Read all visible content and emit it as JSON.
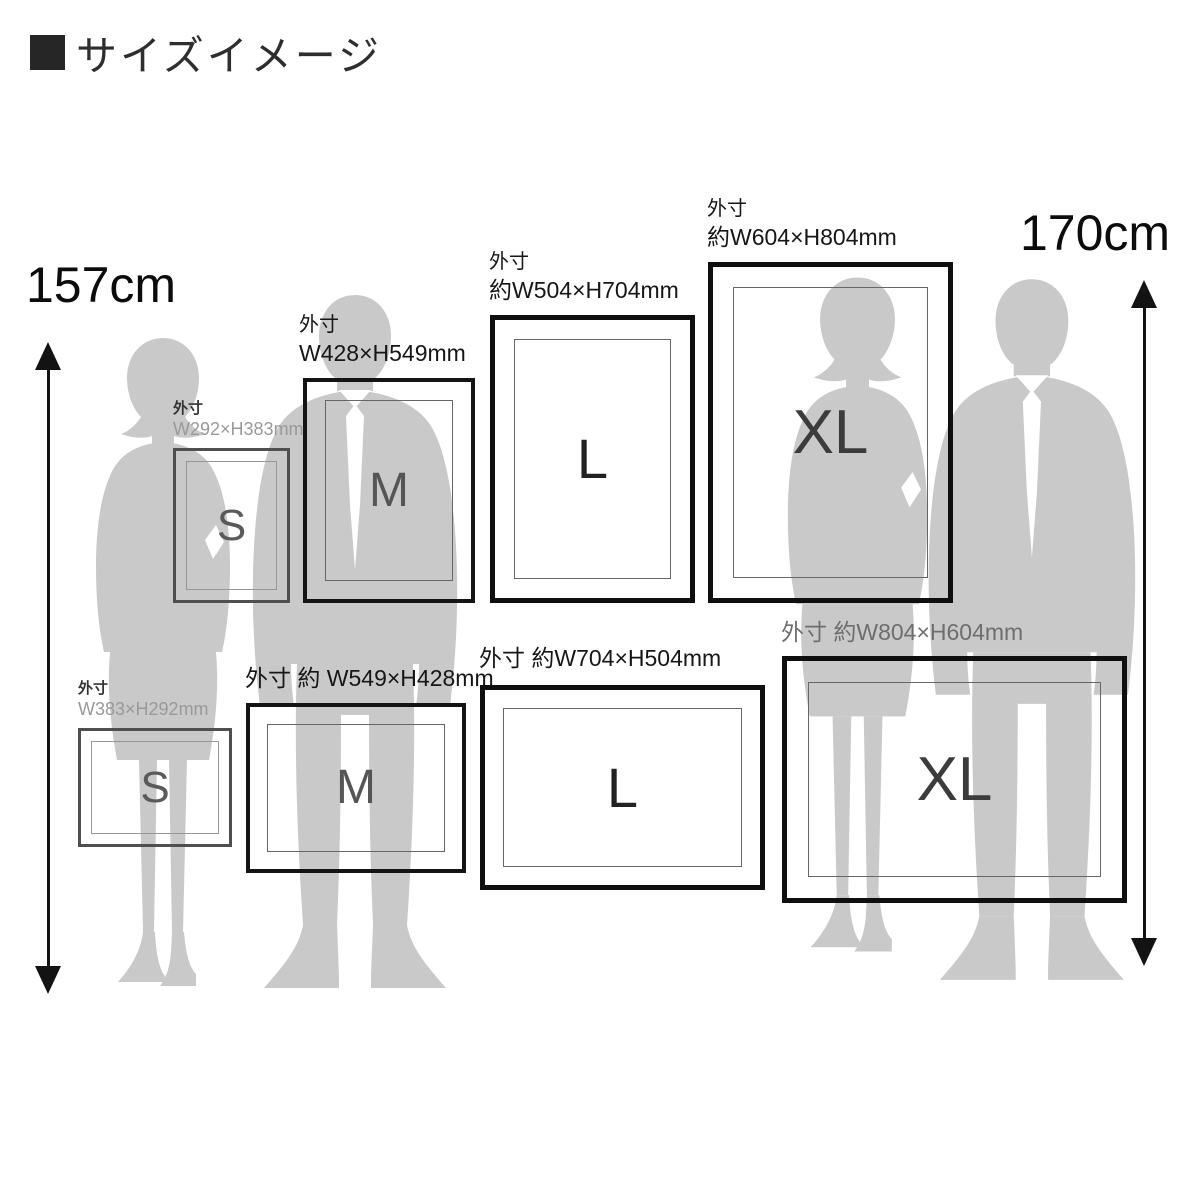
{
  "title": "サイズイメージ",
  "height_markers": {
    "left": "157cm",
    "right": "170cm"
  },
  "frames": {
    "portrait": [
      {
        "size": "S",
        "letter": "S",
        "label_lines": [
          "外寸",
          "W292×H383mm"
        ]
      },
      {
        "size": "M",
        "letter": "M",
        "label_lines": [
          "外寸",
          "W428×H549mm"
        ]
      },
      {
        "size": "L",
        "letter": "L",
        "label_lines": [
          "外寸",
          "約W504×H704mm"
        ]
      },
      {
        "size": "XL",
        "letter": "XL",
        "label_lines": [
          "外寸",
          "約W604×H804mm"
        ]
      }
    ],
    "landscape": [
      {
        "size": "S",
        "letter": "S",
        "label_lines": [
          "外寸",
          "W383×H292mm"
        ]
      },
      {
        "size": "M",
        "letter": "M",
        "label_lines": [
          "外寸 約 W549×H428mm"
        ]
      },
      {
        "size": "L",
        "letter": "L",
        "label_lines": [
          "外寸 約W704×H504mm"
        ]
      },
      {
        "size": "XL",
        "letter": "XL",
        "label_lines": [
          "外寸 約W804×H604mm"
        ]
      }
    ]
  },
  "figures": [
    {
      "name": "woman-silhouette-left"
    },
    {
      "name": "man-silhouette-left"
    },
    {
      "name": "woman-silhouette-right"
    },
    {
      "name": "man-silhouette-right"
    }
  ],
  "colors": {
    "background": "#ffffff",
    "silhouette": "#c9c9c9",
    "frame_border": "#111111",
    "frame_border_s": "#4f4f4f",
    "inner_mat_line": "#666666",
    "dim_text_gray": "#999999",
    "text_black": "#111111"
  }
}
